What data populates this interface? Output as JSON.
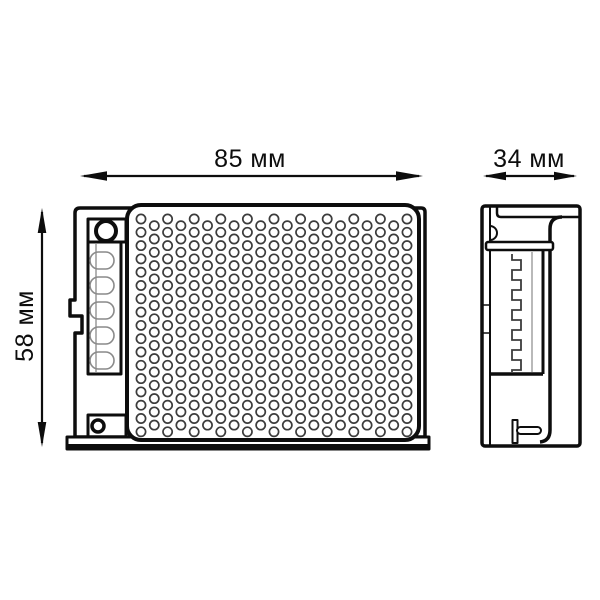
{
  "drawing": {
    "background_color": "#ffffff",
    "line_color": "#0d0d0d",
    "detail_line_color": "#3c3c3c",
    "dimension_labels": {
      "width": "85 мм",
      "depth": "34 мм",
      "height": "58 мм"
    },
    "grille_pattern": {
      "columns": 21,
      "rows_even": 17,
      "rows_odd": 16,
      "spacing": 13.3,
      "stagger_offset": 6.65,
      "hole_radius": 4.6,
      "origin_x": 141,
      "origin_y": 219,
      "max_y": 434
    }
  }
}
